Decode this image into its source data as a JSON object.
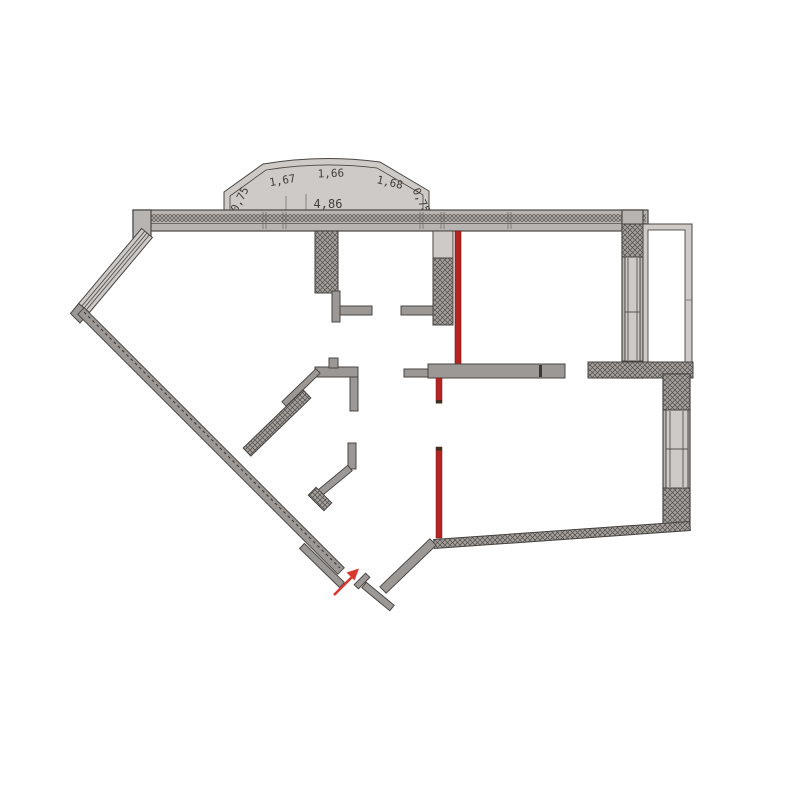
{
  "plan": {
    "bay_labels": [
      "0,75",
      "1,67",
      "1,66",
      "1,68",
      "0,75",
      "4,86"
    ]
  },
  "colors": {
    "red_line": "#b32522",
    "red_tick": "#3f2d22",
    "arrow_red": "#d9362e",
    "wall_gray": "#9b9895",
    "outline": "#4a4643"
  },
  "icons": {
    "entrance_arrow": "arrow-up-right"
  }
}
